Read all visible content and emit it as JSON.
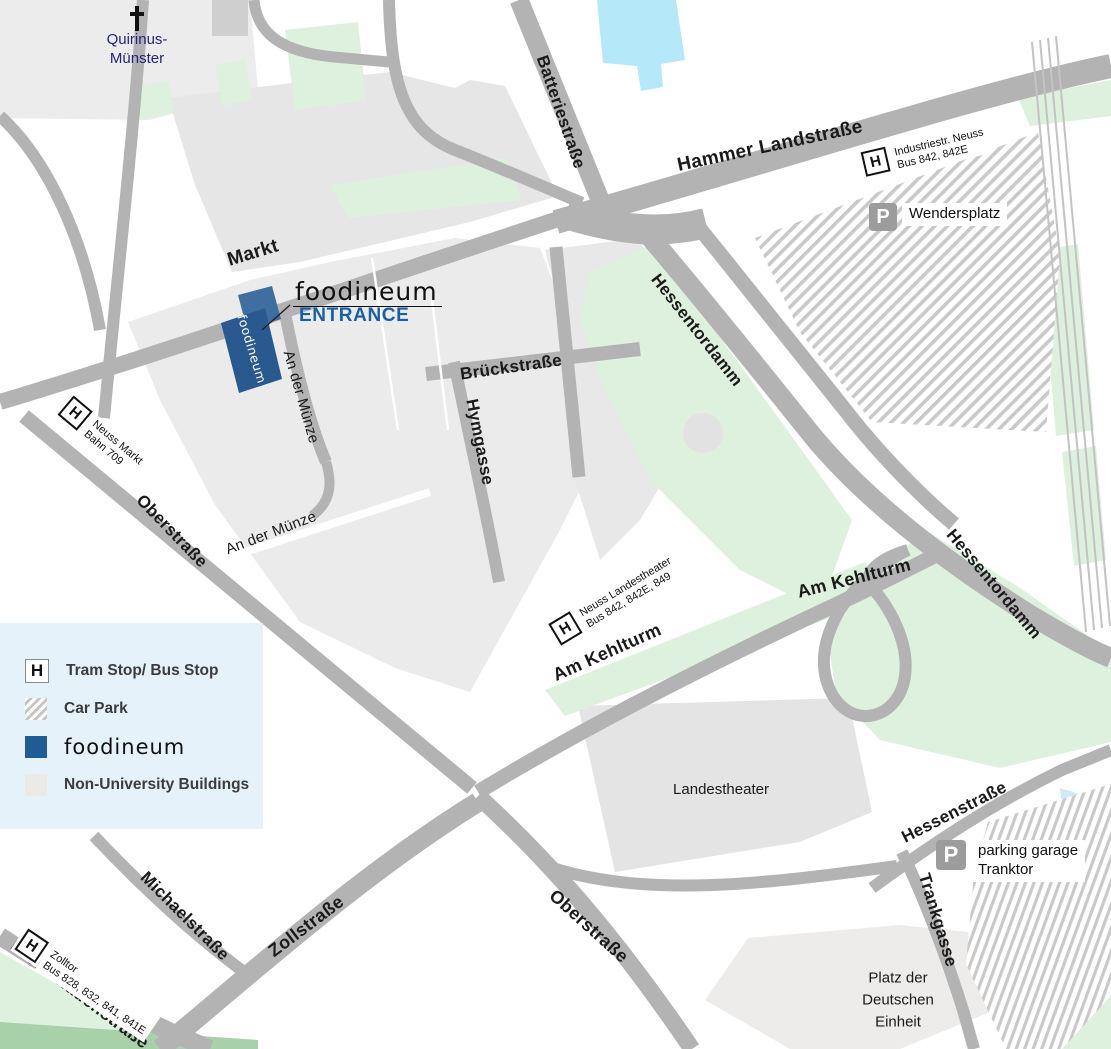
{
  "legend": {
    "items": [
      {
        "icon": "H",
        "label": "Tram Stop/ Bus Stop"
      },
      {
        "icon": "car-park-hatch",
        "label": "Car Park"
      },
      {
        "icon": "foodineum-blue",
        "label": "foodineum"
      },
      {
        "icon": "building-gray",
        "label": "Non-University Buildings"
      }
    ]
  },
  "streets": {
    "markt": "Markt",
    "batteriestrasse": "Batteriestraße",
    "hammer_landstrasse": "Hammer Landstraße",
    "brueckstrasse": "Brückstraße",
    "hymgasse": "Hymgasse",
    "an_der_muenze": "An der Münze",
    "oberstrasse": "Oberstraße",
    "hessentordamm": "Hessentordamm",
    "am_kehlturm": "Am Kehlturm",
    "zollstrasse": "Zollstraße",
    "michaelstrasse": "Michaelstraße",
    "promenadenstrasse": "Promenadenstraße",
    "hessenstrasse": "Hessenstraße",
    "trankgasse": "Trankgasse"
  },
  "places": {
    "quirinus_line1": "Quirinus-",
    "quirinus_line2": "Münster",
    "landestheater": "Landestheater",
    "platz_line1": "Platz der",
    "platz_line2": "Deutschen",
    "platz_line3": "Einheit"
  },
  "stops": [
    {
      "icon": "H",
      "line1": "Industriestr. Neuss",
      "line2": "Bus 842, 842E"
    },
    {
      "icon": "H",
      "line1": "Neuss Markt",
      "line2": "Bahn 709"
    },
    {
      "icon": "H",
      "line1": "Neuss Landestheater",
      "line2": "Bus 842, 842E, 849"
    },
    {
      "icon": "H",
      "line1": "Zolltor",
      "line2": "Bus 828, 832, 841, 841E"
    }
  ],
  "parking": [
    {
      "icon": "P",
      "label": "Wendersplatz"
    },
    {
      "icon": "P",
      "line1": "parking garage",
      "line2": "Tranktor"
    }
  ],
  "foodineum": {
    "title": "foodineum",
    "entrance": "ENTRANCE",
    "building_label": "foodineum"
  },
  "colors": {
    "foodineum_blue": "#29598f",
    "entrance_blue": "#1760a8",
    "road_gray": "#b3b3b3",
    "green": "#def0de",
    "water": "#b5e8f8",
    "legend_bg": "#e5f2f9"
  }
}
